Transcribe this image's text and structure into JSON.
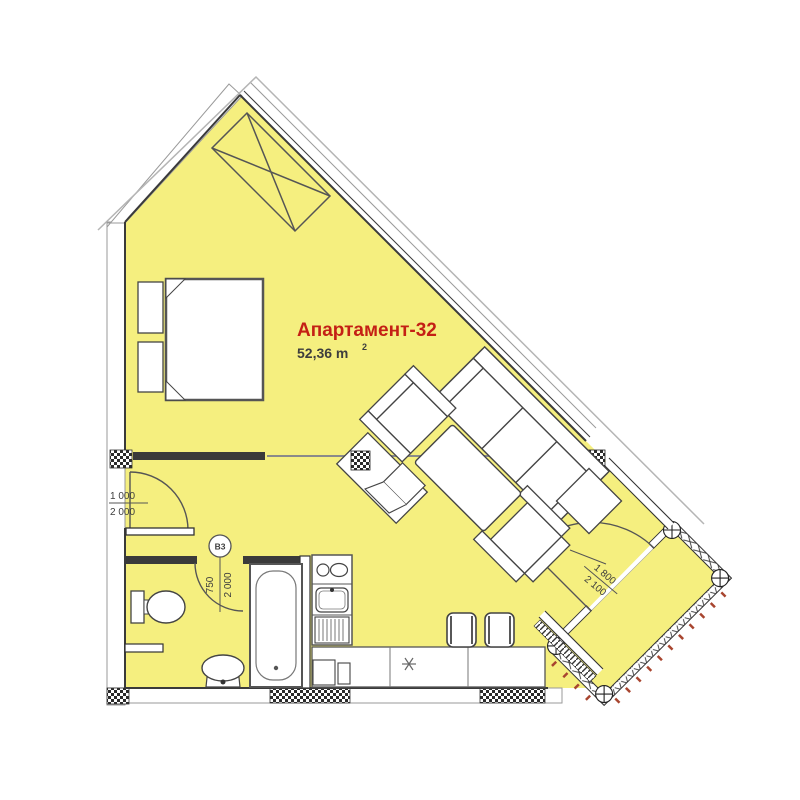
{
  "plan": {
    "title": "Апартамент-32",
    "area": {
      "value": "52,36 m",
      "sup": "2"
    },
    "dims": {
      "entry": {
        "w": "1 000",
        "h": "2 000"
      },
      "bath": {
        "tag": "B3",
        "w": "750",
        "h": "2 000"
      },
      "balcony": {
        "w": "1 800",
        "h": "2 100"
      }
    },
    "colors": {
      "room": "#f5ef7f",
      "title": "#c42015",
      "text": "#3d3d3d",
      "tick": "#a8452f"
    }
  }
}
